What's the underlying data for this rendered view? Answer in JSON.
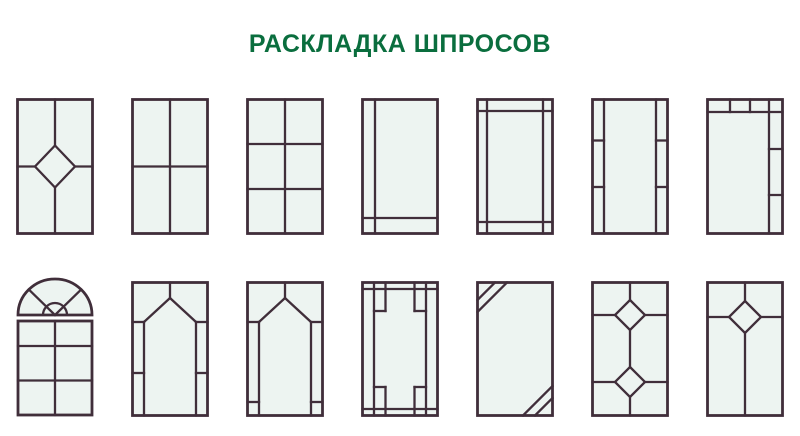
{
  "page": {
    "title": "РАСКЛАДКА ШПРОСОВ",
    "title_color": "#0a6e3e",
    "background": "#ffffff"
  },
  "style": {
    "frame_color": "#402e3a",
    "glass_color": "#edf4f1",
    "stroke_width": 2.3,
    "frame_stroke_width": 2.8
  },
  "rows": [
    {
      "name": "row-1",
      "windows": [
        {
          "name": "diamond-center",
          "w": 78,
          "h": 137,
          "shapes": [
            {
              "t": "rect",
              "x": 1.5,
              "y": 1.5,
              "w": 75,
              "h": 134,
              "fill": "glass",
              "sw": 2.8
            },
            {
              "t": "line",
              "x1": 39,
              "y1": 1.5,
              "x2": 39,
              "y2": 47.5
            },
            {
              "t": "line",
              "x1": 39,
              "y1": 89.5,
              "x2": 39,
              "y2": 135.5
            },
            {
              "t": "line",
              "x1": 1.5,
              "y1": 68.5,
              "x2": 19,
              "y2": 68.5
            },
            {
              "t": "line",
              "x1": 59,
              "y1": 68.5,
              "x2": 76.5,
              "y2": 68.5
            },
            {
              "t": "poly",
              "pts": "39,47.5 59,68.5 39,89.5 19,68.5"
            }
          ]
        },
        {
          "name": "four-pane-cross",
          "w": 78,
          "h": 137,
          "shapes": [
            {
              "t": "rect",
              "x": 1.5,
              "y": 1.5,
              "w": 75,
              "h": 134,
              "fill": "glass",
              "sw": 2.8
            },
            {
              "t": "line",
              "x1": 39,
              "y1": 1.5,
              "x2": 39,
              "y2": 135.5
            },
            {
              "t": "line",
              "x1": 1.5,
              "y1": 68.5,
              "x2": 76.5,
              "y2": 68.5
            }
          ]
        },
        {
          "name": "six-pane-grid",
          "w": 78,
          "h": 137,
          "shapes": [
            {
              "t": "rect",
              "x": 1.5,
              "y": 1.5,
              "w": 75,
              "h": 134,
              "fill": "glass",
              "sw": 2.8
            },
            {
              "t": "line",
              "x1": 39,
              "y1": 1.5,
              "x2": 39,
              "y2": 135.5
            },
            {
              "t": "line",
              "x1": 1.5,
              "y1": 46,
              "x2": 76.5,
              "y2": 46
            },
            {
              "t": "line",
              "x1": 1.5,
              "y1": 91,
              "x2": 76.5,
              "y2": 91
            }
          ]
        },
        {
          "name": "edge-left-bottom",
          "w": 78,
          "h": 137,
          "shapes": [
            {
              "t": "rect",
              "x": 1.5,
              "y": 1.5,
              "w": 75,
              "h": 134,
              "fill": "glass",
              "sw": 2.8
            },
            {
              "t": "line",
              "x1": 14,
              "y1": 1.5,
              "x2": 14,
              "y2": 135.5
            },
            {
              "t": "line",
              "x1": 1.5,
              "y1": 120,
              "x2": 76.5,
              "y2": 120
            }
          ]
        },
        {
          "name": "inset-border-cross",
          "w": 78,
          "h": 137,
          "shapes": [
            {
              "t": "rect",
              "x": 1.5,
              "y": 1.5,
              "w": 75,
              "h": 134,
              "fill": "glass",
              "sw": 2.8
            },
            {
              "t": "line",
              "x1": 11,
              "y1": 1.5,
              "x2": 11,
              "y2": 135.5
            },
            {
              "t": "line",
              "x1": 67,
              "y1": 1.5,
              "x2": 67,
              "y2": 135.5
            },
            {
              "t": "line",
              "x1": 1.5,
              "y1": 13,
              "x2": 76.5,
              "y2": 13
            },
            {
              "t": "line",
              "x1": 1.5,
              "y1": 124,
              "x2": 76.5,
              "y2": 124
            }
          ]
        },
        {
          "name": "side-strips",
          "w": 78,
          "h": 137,
          "shapes": [
            {
              "t": "rect",
              "x": 1.5,
              "y": 1.5,
              "w": 75,
              "h": 134,
              "fill": "glass",
              "sw": 2.8
            },
            {
              "t": "line",
              "x1": 13,
              "y1": 1.5,
              "x2": 13,
              "y2": 135.5
            },
            {
              "t": "line",
              "x1": 65,
              "y1": 1.5,
              "x2": 65,
              "y2": 135.5
            },
            {
              "t": "line",
              "x1": 1.5,
              "y1": 42.5,
              "x2": 13,
              "y2": 42.5
            },
            {
              "t": "line",
              "x1": 1.5,
              "y1": 89,
              "x2": 13,
              "y2": 89
            },
            {
              "t": "line",
              "x1": 65,
              "y1": 42.5,
              "x2": 76.5,
              "y2": 42.5
            },
            {
              "t": "line",
              "x1": 65,
              "y1": 89,
              "x2": 76.5,
              "y2": 89
            }
          ]
        },
        {
          "name": "top-band-right-strip",
          "w": 78,
          "h": 137,
          "shapes": [
            {
              "t": "rect",
              "x": 1.5,
              "y": 1.5,
              "w": 75,
              "h": 134,
              "fill": "glass",
              "sw": 2.8
            },
            {
              "t": "line",
              "x1": 1.5,
              "y1": 14,
              "x2": 76.5,
              "y2": 14
            },
            {
              "t": "line",
              "x1": 63,
              "y1": 1.5,
              "x2": 63,
              "y2": 135.5
            },
            {
              "t": "line",
              "x1": 24,
              "y1": 1.5,
              "x2": 24,
              "y2": 14
            },
            {
              "t": "line",
              "x1": 44,
              "y1": 1.5,
              "x2": 44,
              "y2": 14
            },
            {
              "t": "line",
              "x1": 63,
              "y1": 51,
              "x2": 76.5,
              "y2": 51
            },
            {
              "t": "line",
              "x1": 63,
              "y1": 97,
              "x2": 76.5,
              "y2": 97
            }
          ]
        }
      ]
    },
    {
      "name": "row-2",
      "windows": [
        {
          "name": "arch-fan-six-pane",
          "w": 78,
          "h": 140,
          "shapes": [
            {
              "t": "path",
              "d": "M 2 38 A 37 36 0 0 1 76 38 L 2 38 Z",
              "fill": "glass",
              "sw": 2.8
            },
            {
              "t": "line",
              "x1": 39,
              "y1": 38,
              "x2": 12.8,
              "y2": 12.5
            },
            {
              "t": "line",
              "x1": 39,
              "y1": 38,
              "x2": 65.2,
              "y2": 12.5
            },
            {
              "t": "path",
              "d": "M 27 38 A 12 12 0 0 1 51 38",
              "fill": "none"
            },
            {
              "t": "rect",
              "x": 2,
              "y": 44,
              "w": 74,
              "h": 94,
              "fill": "glass",
              "sw": 2.8
            },
            {
              "t": "line",
              "x1": 39,
              "y1": 44,
              "x2": 39,
              "y2": 138
            },
            {
              "t": "line",
              "x1": 2,
              "y1": 69,
              "x2": 76,
              "y2": 69
            },
            {
              "t": "line",
              "x1": 2,
              "y1": 103.5,
              "x2": 76,
              "y2": 103.5
            }
          ]
        },
        {
          "name": "lancet-arch-low-ticks",
          "w": 78,
          "h": 136,
          "shapes": [
            {
              "t": "rect",
              "x": 1.5,
              "y": 1.5,
              "w": 75,
              "h": 133,
              "fill": "glass",
              "sw": 2.8
            },
            {
              "t": "line",
              "x1": 13,
              "y1": 41,
              "x2": 13,
              "y2": 134.5
            },
            {
              "t": "line",
              "x1": 65,
              "y1": 41,
              "x2": 65,
              "y2": 134.5
            },
            {
              "t": "line",
              "x1": 1.5,
              "y1": 41,
              "x2": 13,
              "y2": 41
            },
            {
              "t": "line",
              "x1": 65,
              "y1": 41,
              "x2": 76.5,
              "y2": 41
            },
            {
              "t": "line",
              "x1": 1.5,
              "y1": 92,
              "x2": 13,
              "y2": 92
            },
            {
              "t": "line",
              "x1": 65,
              "y1": 92,
              "x2": 76.5,
              "y2": 92
            },
            {
              "t": "line",
              "x1": 13,
              "y1": 41,
              "x2": 39,
              "y2": 17
            },
            {
              "t": "line",
              "x1": 65,
              "y1": 41,
              "x2": 39,
              "y2": 17
            },
            {
              "t": "line",
              "x1": 39,
              "y1": 1.5,
              "x2": 39,
              "y2": 17
            }
          ]
        },
        {
          "name": "lancet-arch-bottom-ticks",
          "w": 78,
          "h": 136,
          "shapes": [
            {
              "t": "rect",
              "x": 1.5,
              "y": 1.5,
              "w": 75,
              "h": 133,
              "fill": "glass",
              "sw": 2.8
            },
            {
              "t": "line",
              "x1": 13,
              "y1": 41,
              "x2": 13,
              "y2": 134.5
            },
            {
              "t": "line",
              "x1": 65,
              "y1": 41,
              "x2": 65,
              "y2": 134.5
            },
            {
              "t": "line",
              "x1": 1.5,
              "y1": 41,
              "x2": 13,
              "y2": 41
            },
            {
              "t": "line",
              "x1": 65,
              "y1": 41,
              "x2": 76.5,
              "y2": 41
            },
            {
              "t": "line",
              "x1": 1.5,
              "y1": 121,
              "x2": 13,
              "y2": 121
            },
            {
              "t": "line",
              "x1": 65,
              "y1": 121,
              "x2": 76.5,
              "y2": 121
            },
            {
              "t": "line",
              "x1": 13,
              "y1": 41,
              "x2": 39,
              "y2": 17
            },
            {
              "t": "line",
              "x1": 65,
              "y1": 41,
              "x2": 39,
              "y2": 17
            },
            {
              "t": "line",
              "x1": 39,
              "y1": 1.5,
              "x2": 39,
              "y2": 17
            }
          ]
        },
        {
          "name": "fret-corners",
          "w": 78,
          "h": 136,
          "shapes": [
            {
              "t": "rect",
              "x": 1.5,
              "y": 1.5,
              "w": 75,
              "h": 133,
              "fill": "glass",
              "sw": 2.8
            },
            {
              "t": "line",
              "x1": 1.5,
              "y1": 8,
              "x2": 76.5,
              "y2": 8
            },
            {
              "t": "line",
              "x1": 1.5,
              "y1": 128,
              "x2": 76.5,
              "y2": 128
            },
            {
              "t": "line",
              "x1": 13,
              "y1": 1.5,
              "x2": 13,
              "y2": 134.5
            },
            {
              "t": "line",
              "x1": 65,
              "y1": 1.5,
              "x2": 65,
              "y2": 134.5
            },
            {
              "t": "line",
              "x1": 24.5,
              "y1": 1.5,
              "x2": 24.5,
              "y2": 30
            },
            {
              "t": "line",
              "x1": 53.5,
              "y1": 1.5,
              "x2": 53.5,
              "y2": 30
            },
            {
              "t": "line",
              "x1": 24.5,
              "y1": 106,
              "x2": 24.5,
              "y2": 134.5
            },
            {
              "t": "line",
              "x1": 53.5,
              "y1": 106,
              "x2": 53.5,
              "y2": 134.5
            },
            {
              "t": "line",
              "x1": 13,
              "y1": 30,
              "x2": 24.5,
              "y2": 30
            },
            {
              "t": "line",
              "x1": 53.5,
              "y1": 30,
              "x2": 65,
              "y2": 30
            },
            {
              "t": "line",
              "x1": 13,
              "y1": 106,
              "x2": 24.5,
              "y2": 106
            },
            {
              "t": "line",
              "x1": 53.5,
              "y1": 106,
              "x2": 65,
              "y2": 106
            }
          ]
        },
        {
          "name": "corner-diagonals",
          "w": 78,
          "h": 136,
          "shapes": [
            {
              "t": "rect",
              "x": 1.5,
              "y": 1.5,
              "w": 75,
              "h": 133,
              "fill": "glass",
              "sw": 2.8
            },
            {
              "t": "line",
              "x1": 1.5,
              "y1": 19,
              "x2": 19,
              "y2": 1.5
            },
            {
              "t": "line",
              "x1": 1.5,
              "y1": 31,
              "x2": 31,
              "y2": 1.5
            },
            {
              "t": "line",
              "x1": 59,
              "y1": 134.5,
              "x2": 76.5,
              "y2": 117
            },
            {
              "t": "line",
              "x1": 47,
              "y1": 134.5,
              "x2": 76.5,
              "y2": 105
            }
          ]
        },
        {
          "name": "double-diamond",
          "w": 78,
          "h": 136,
          "shapes": [
            {
              "t": "rect",
              "x": 1.5,
              "y": 1.5,
              "w": 75,
              "h": 133,
              "fill": "glass",
              "sw": 2.8
            },
            {
              "t": "poly",
              "pts": "39,19 54,34 39,49 24,34"
            },
            {
              "t": "poly",
              "pts": "39,86 54,101 39,116 24,101"
            },
            {
              "t": "line",
              "x1": 39,
              "y1": 1.5,
              "x2": 39,
              "y2": 19
            },
            {
              "t": "line",
              "x1": 39,
              "y1": 49,
              "x2": 39,
              "y2": 86
            },
            {
              "t": "line",
              "x1": 39,
              "y1": 116,
              "x2": 39,
              "y2": 134.5
            },
            {
              "t": "line",
              "x1": 1.5,
              "y1": 34,
              "x2": 24,
              "y2": 34
            },
            {
              "t": "line",
              "x1": 54,
              "y1": 34,
              "x2": 76.5,
              "y2": 34
            },
            {
              "t": "line",
              "x1": 1.5,
              "y1": 101,
              "x2": 24,
              "y2": 101
            },
            {
              "t": "line",
              "x1": 54,
              "y1": 101,
              "x2": 76.5,
              "y2": 101
            }
          ]
        },
        {
          "name": "single-diamond-high",
          "w": 78,
          "h": 136,
          "shapes": [
            {
              "t": "rect",
              "x": 1.5,
              "y": 1.5,
              "w": 75,
              "h": 133,
              "fill": "glass",
              "sw": 2.8
            },
            {
              "t": "poly",
              "pts": "39,20 55,36 39,52 23,36"
            },
            {
              "t": "line",
              "x1": 39,
              "y1": 1.5,
              "x2": 39,
              "y2": 20
            },
            {
              "t": "line",
              "x1": 39,
              "y1": 52,
              "x2": 39,
              "y2": 134.5
            },
            {
              "t": "line",
              "x1": 1.5,
              "y1": 36,
              "x2": 23,
              "y2": 36
            },
            {
              "t": "line",
              "x1": 55,
              "y1": 36,
              "x2": 76.5,
              "y2": 36
            }
          ]
        }
      ]
    }
  ]
}
